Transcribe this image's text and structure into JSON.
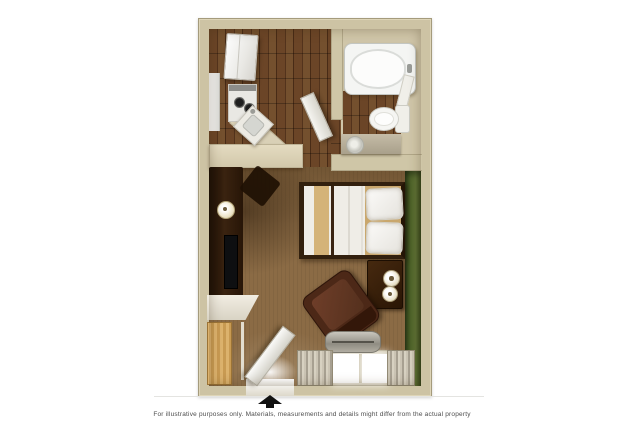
{
  "page": {
    "background_color": "#ffffff"
  },
  "floor_plan": {
    "description": "3D rendered studio suite floor plan",
    "colors": {
      "wall_beige": "#cdc3a4",
      "accent_wall_green": "#4e6329",
      "wood_floor_brown": "#5e3c22",
      "carpet_tan": "#8b6b45",
      "counter_cream": "#d9d0b6",
      "fixtures_white": "#f2f1ed",
      "furniture_dark_wood": "#331d0d"
    },
    "rooms": [
      {
        "name": "kitchen",
        "furniture": [
          "refrigerator",
          "kitchen-cabinets",
          "stove",
          "kitchen-sink",
          "kitchen-counter"
        ]
      },
      {
        "name": "bathroom",
        "furniture": [
          "bathtub",
          "toilet",
          "vanity-sink",
          "bathroom-door",
          "towel"
        ]
      },
      {
        "name": "living-sleeping-area",
        "furniture": [
          "queen-bed",
          "pillows",
          "nightstand",
          "table-lamps",
          "armchair",
          "media-console",
          "television",
          "console-lamp",
          "wall-desk",
          "closet",
          "entry-door",
          "window",
          "curtains",
          "hvac-unit"
        ]
      }
    ]
  },
  "entrance": {
    "indicator": "arrow-up"
  },
  "disclaimer": {
    "text": "For illustrative purposes only.  Materials, measurements and details might differ from the actual property"
  }
}
